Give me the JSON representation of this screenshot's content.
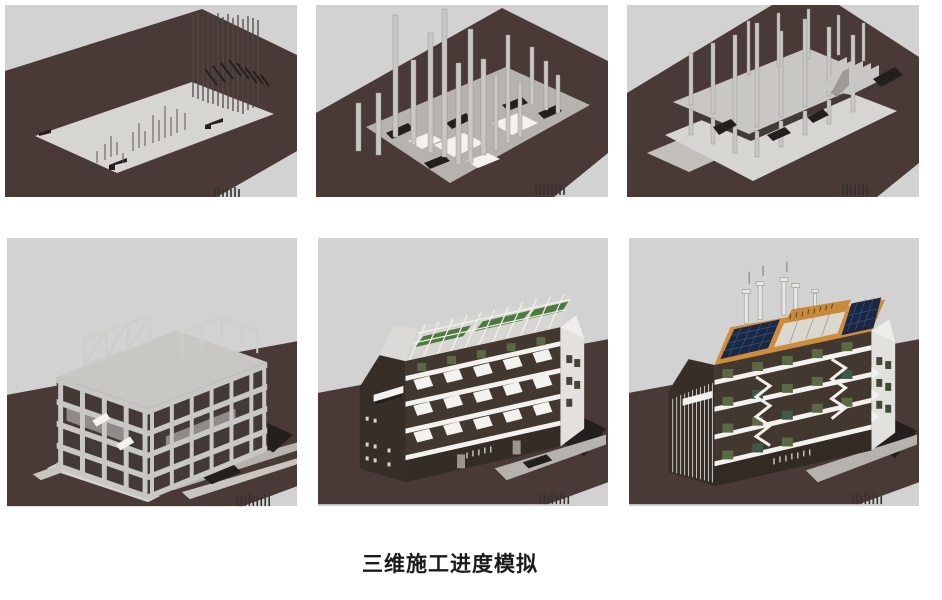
{
  "caption": {
    "text": "三维施工进度模拟"
  },
  "colors": {
    "page_bg": "#ffffff",
    "sky": "#d2d2d2",
    "ground": "#4a3a37",
    "slab": "#d7d5d2",
    "concrete": "#c9c7c4",
    "interior": "#443a35",
    "shadow": "#241f1d",
    "facade": "#43382f",
    "facade_dark": "#372e27",
    "white": "#f3f2ef",
    "orange": "#cf8c3b",
    "solar": "#1b2843",
    "green": "#4d7a3e",
    "olive": "#5b6a44",
    "caption_color": "#1a1a1a"
  }
}
